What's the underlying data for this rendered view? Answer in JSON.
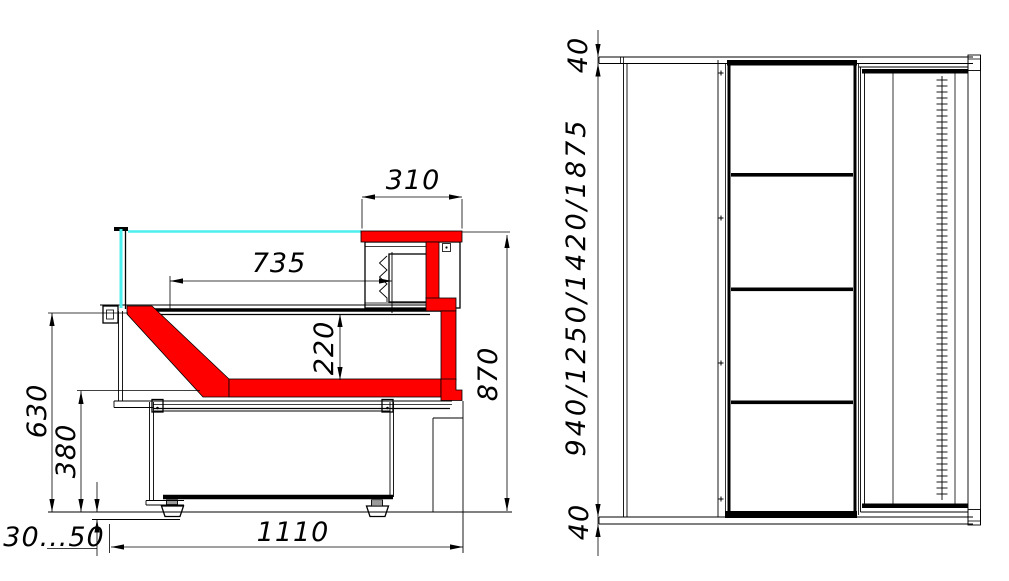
{
  "drawing": {
    "type": "technical-dimension-drawing",
    "colors": {
      "line": "#000000",
      "highlight_red": "#ff0000",
      "glass_cyan": "#4deeee",
      "background": "#ffffff"
    },
    "left_view": {
      "dims": {
        "canopy_depth": "310",
        "display_depth": "735",
        "well_height": "220",
        "back_height": "870",
        "front_height": "630",
        "base_height": "380",
        "leg_adjust": "30...50",
        "overall_depth": "1110"
      }
    },
    "right_view": {
      "dims": {
        "top_panel_thickness": "40",
        "height_variants": "940/1250/1420/1875",
        "bottom_panel_thickness": "40"
      }
    }
  }
}
